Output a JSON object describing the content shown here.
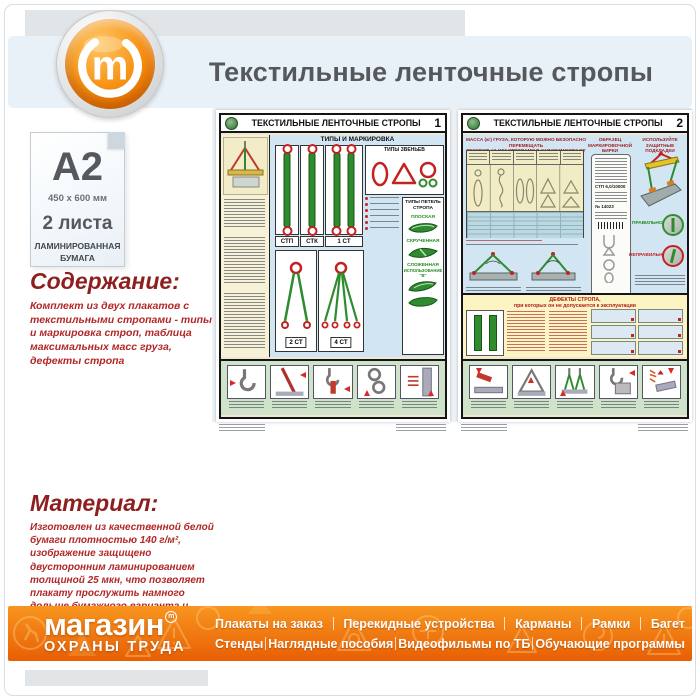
{
  "header": {
    "title": "Текстильные ленточные стропы (С-72)",
    "logo_letter": "m"
  },
  "product": {
    "format": "A2",
    "dimensions": "450 x 600 мм",
    "sheets": "2 листа",
    "paper": [
      "ЛАМИНИРОВАННАЯ",
      "БУМАГА"
    ],
    "content_heading": "Содержание:",
    "content_text": "Комплект из двух плакатов с текстильными стропами - типы и маркировка строп, таблица максимальных масс груза, дефекты стропа",
    "material_heading": "Материал:",
    "material_text": "Изготовлен из качественной белой бумаги плотностью 140 г/м², изображение защищено двусторонним ламинированием толщиной 25 мкн, что позволяет плакату прослужить намного дольше бумажного варианта и такой плакат не боится влаги - его смело можно протирать."
  },
  "poster1": {
    "number": "1",
    "title": "ТЕКСТИЛЬНЫЕ ЛЕНТОЧНЫЕ СТРОПЫ",
    "types_title": "ТИПЫ И МАРКИРОВКА",
    "links_title": "ТИПЫ ЗВЕНЬЕВ",
    "loops_title": "ТИПЫ ПЕТЕЛЬ СТРОПА",
    "labels": [
      "СТП",
      "СТК",
      "1 СТ",
      "2 СТ",
      "4 СТ"
    ],
    "loops": [
      "ПЛОСКАЯ",
      "СКРУЧЕННАЯ",
      "СЛОЖЕННАЯ"
    ],
    "loops_sub": "ИСПОЛЬЗОВАНИЕ \"В\""
  },
  "poster2": {
    "number": "2",
    "title": "ТЕКСТИЛЬНЫЕ ЛЕНТОЧНЫЕ СТРОПЫ",
    "table_title1": "МАССА (кг) ГРУЗА, КОТОРУЮ МОЖНО БЕЗОПАСНО ПЕРЕМЕЩАТЬ",
    "table_title2": "ТЕКСТИЛЬНЫМИ СТРОПАМИ В ЗАВИСИМОСТИ ОТ СПОСОБА СТРОПОВКИ",
    "tag_title": "ОБРАЗЕЦ МАРКИРОВОЧНОЙ БИРКИ",
    "tag_lines": [
      "СТП 6,0/10000",
      "№ 14023"
    ],
    "pads_title": "ИСПОЛЬЗУЙТЕ ЗАЩИТНЫЕ ПОДКЛАДКИ",
    "correct_label": "ПРАВИЛЬНО",
    "incorrect_label": "НЕПРАВИЛЬНО",
    "defects_title1": "ДЕФЕКТЫ СТРОПА,",
    "defects_title2": "при которых он не допускается к эксплуатации"
  },
  "footer": {
    "brand_top": "магазин",
    "brand_mark": "m",
    "brand_bottom": "ОХРАНЫ ТРУДА",
    "nav_row1": [
      "Плакаты на заказ",
      "Перекидные устройства",
      "Карманы",
      "Рамки",
      "Багет"
    ],
    "nav_row2": [
      "Стенды",
      "Наглядные пособия",
      "Видеофильмы по ТБ",
      "Обучающие программы"
    ]
  },
  "colors": {
    "accent_orange": "#f4820c",
    "band_blue": "#e9f1f8",
    "heading_red": "#8e1f1f",
    "text_red": "#b22727",
    "title_gray": "#56585b",
    "strap_green": "#2e8b2e",
    "warning_red": "#c32222"
  }
}
